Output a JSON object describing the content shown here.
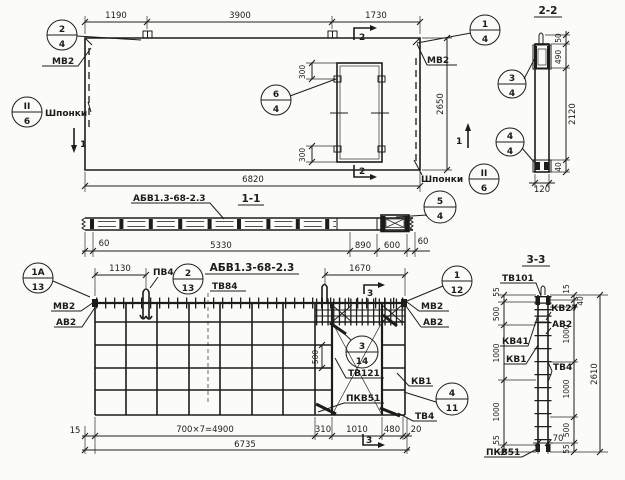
{
  "drawing_title": "АБВ1.3-68-2.3",
  "plan": {
    "dim_1190": "1190",
    "dim_3900": "3900",
    "dim_1730": "1730",
    "dim_6820": "6820",
    "dim_2650": "2650",
    "dim_300_top": "300",
    "dim_300_bottom": "300",
    "label_mv2_left": "МВ2",
    "label_mv2_right": "МВ2",
    "label_shponki_left": "Шпонки",
    "label_shponki_right": "Шпонки",
    "mark_1_left": "1",
    "mark_1_right": "1",
    "mark_2_top": "2",
    "mark_2_bottom": "2"
  },
  "callouts": {
    "c1": {
      "top": "2",
      "bottom": "4"
    },
    "c2": {
      "top": "1",
      "bottom": "4"
    },
    "c3": {
      "top": "6",
      "bottom": "4"
    },
    "c4": {
      "top": "II",
      "bottom": "6"
    },
    "c5": {
      "top": "II",
      "bottom": "6"
    },
    "c6": {
      "top": "3",
      "bottom": "4"
    },
    "c7": {
      "top": "4",
      "bottom": "4"
    },
    "c8": {
      "top": "5",
      "bottom": "4"
    },
    "c9": {
      "top": "1А",
      "bottom": "13"
    },
    "c10": {
      "top": "2",
      "bottom": "13"
    },
    "c11": {
      "top": "1",
      "bottom": "12"
    },
    "c12": {
      "top": "3",
      "bottom": "14"
    },
    "c13": {
      "top": "4",
      "bottom": "11"
    }
  },
  "section11": {
    "title": "1-1",
    "mark": "АБВ1.3-68-2.3",
    "dim_60_left": "60",
    "dim_5330": "5330",
    "dim_890": "890",
    "dim_600": "600",
    "dim_60_right": "60"
  },
  "section22": {
    "title": "2-2",
    "dim_50": "50",
    "dim_490": "490",
    "dim_2120": "2120",
    "dim_40": "40",
    "dim_120": "120"
  },
  "rebar": {
    "title": "АБВ1.3-68-2.3",
    "label_tv84": "ТВ84",
    "label_pv4": "ПВ4",
    "label_mv2_left": "МВ2",
    "label_av2_left": "АВ2",
    "label_mv2_right": "МВ2",
    "label_av2_right": "АВ2",
    "label_tv121": "ТВ121",
    "label_kv1": "КВ1",
    "label_pkv51": "ПКВ51",
    "label_tv4": "ТВ4",
    "dim_1130": "1130",
    "dim_1670": "1670",
    "dim_500": "500",
    "dim_15": "15",
    "dim_run": "700×7=4900",
    "dim_310": "310",
    "dim_1010": "1010",
    "dim_480": "480",
    "dim_20": "20",
    "dim_6735": "6735",
    "mark_3_top": "3",
    "mark_3_bottom": "3"
  },
  "section33": {
    "title": "3-3",
    "label_tv101": "ТВ101",
    "label_kv41": "КВ41",
    "label_kv1": "КВ1",
    "label_pkv51": "ПКВ51",
    "label_kv27": "КВ27",
    "label_av2": "АВ2",
    "label_tv4": "ТВ4",
    "left_dims": [
      "55",
      "500",
      "1000",
      "1000",
      "55"
    ],
    "right_dims": [
      "15",
      "40",
      "1000",
      "1000",
      "500",
      "55"
    ],
    "dim_2610": "2610",
    "dim_70": "70"
  }
}
